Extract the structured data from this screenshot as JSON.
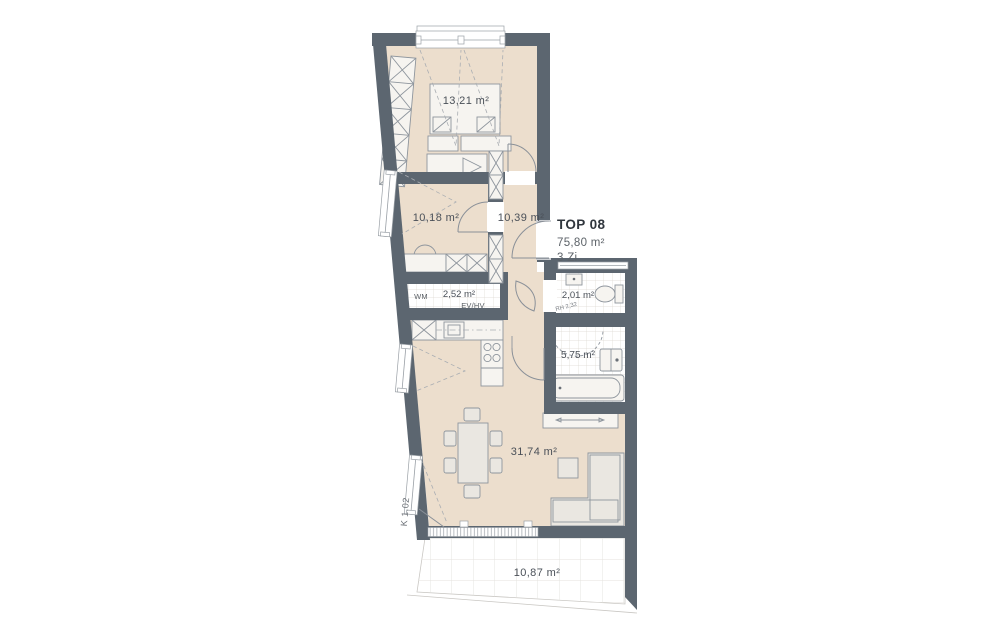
{
  "apartment": {
    "name": "TOP 08",
    "total_area": "75,80 m²",
    "room_count": "3 Zi."
  },
  "rooms": {
    "bedroom1": {
      "area": "13,21 m²"
    },
    "bedroom2": {
      "area": "10,18 m²"
    },
    "hall": {
      "area": "10,39 m²"
    },
    "utility": {
      "area": "2,52 m²",
      "appliance": "WM",
      "panel": "EV/HV"
    },
    "wc": {
      "area": "2,01 m²",
      "height_note": "RH 2,32"
    },
    "bath": {
      "area": "5,75 m²"
    },
    "living": {
      "area": "31,74 m²"
    },
    "terrace": {
      "area": "10,87 m²"
    }
  },
  "annotations": {
    "corridor": "K 1.02"
  },
  "colors": {
    "wall": "#5c6670",
    "floor": "#ecdecd",
    "tile_line": "#ddd8d2"
  }
}
